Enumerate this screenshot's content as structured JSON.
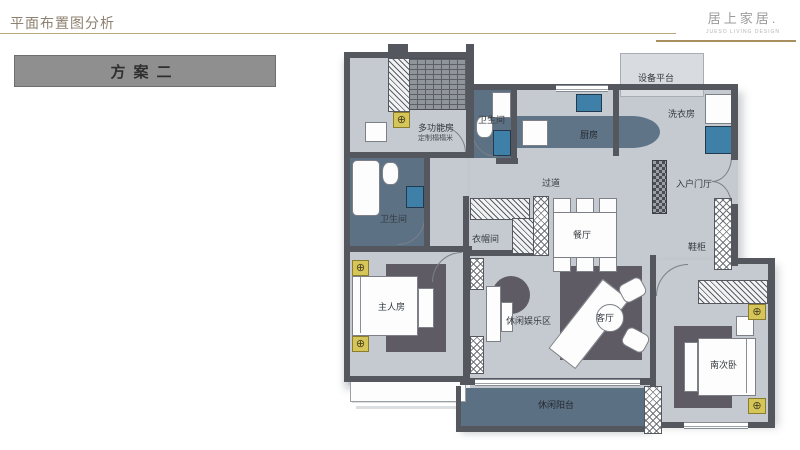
{
  "header": {
    "title": "平面布置图分析",
    "brand": "居上家居.",
    "brand_sub": "JUESO LIVING DESIGN"
  },
  "scheme_label": "方案二",
  "icons": {
    "lamp": "⊕"
  },
  "colors": {
    "accent_line": "#b8a77f",
    "brand_line": "#a98f5d",
    "wall": "#54575e",
    "floor": "#c5cad0",
    "wet_area": "#5d7185",
    "rug": "#5e5b65",
    "lamp_gold": "#d6c659",
    "scheme_box": "#8f8f8f"
  },
  "rooms": {
    "multi_function": {
      "label": "多功能房",
      "sub": "定制榻榻米"
    },
    "bath_top": {
      "label": "卫生间"
    },
    "kitchen": {
      "label": "厨房"
    },
    "laundry": {
      "label": "洗衣房"
    },
    "equipment_platform": {
      "label": "设备平台"
    },
    "corridor": {
      "label": "过道"
    },
    "entry_hall": {
      "label": "入户门厅"
    },
    "bath_master": {
      "label": "卫生间"
    },
    "cloakroom": {
      "label": "衣帽间"
    },
    "dining": {
      "label": "餐厅"
    },
    "shoe_cabinet": {
      "label": "鞋柜"
    },
    "master_bedroom": {
      "label": "主人房"
    },
    "leisure_zone": {
      "label": "休闲娱乐区"
    },
    "living_room": {
      "label": "客厅"
    },
    "south_bedroom": {
      "label": "南次卧"
    },
    "balcony": {
      "label": "休闲阳台"
    }
  }
}
